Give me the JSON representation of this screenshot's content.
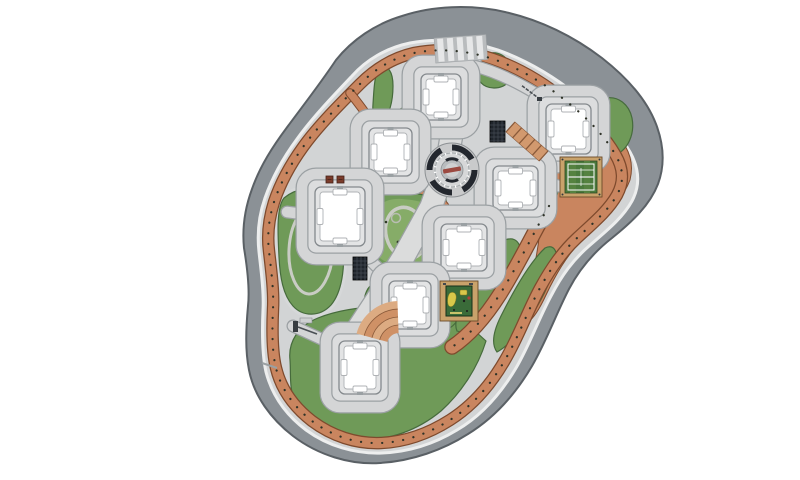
{
  "meta": {
    "title": "Residential complex landscape master plan",
    "canvas": {
      "width": 800,
      "height": 480
    },
    "view": "top-down site plan, no visible text labels"
  },
  "palette": {
    "background": "#FFFFFF",
    "road": "#8B9196",
    "road_border": "#5A6065",
    "sidewalk": "#EDEEEE",
    "pavement": "#D2D4D5",
    "pavement_edge": "#9BA0A3",
    "track": "#C9855F",
    "track_border": "#7E4A2D",
    "lawn": "#6F9A58",
    "lawn_border": "#466B3C",
    "building_ring": "#DCDDDE",
    "building_border": "#84898D",
    "building_fill": "#FFFFFF",
    "building_inner_border": "#AFB2B5",
    "plaza_dark": "#23272E",
    "plaza_ring": "#C9CACB",
    "plaza_accent": "#9C4A41",
    "court_ground": "#C9A26B",
    "court_green": "#4B7A3C",
    "court_line": "#FFFFFF",
    "play_court": "#3A6B39",
    "play_equipment": "#D9C84A",
    "pergola": "#1F242B",
    "stairs_light": "#DCAB82",
    "stairs_dark": "#CF9166",
    "tree_dot": "#2F3328",
    "playground_green": "#86AC68",
    "playground_path": "#C9CCC4"
  },
  "site": {
    "buildings": [
      {
        "id": "building-1",
        "x": 421,
        "y": 74,
        "w": 40,
        "h": 46
      },
      {
        "id": "building-2",
        "x": 369,
        "y": 128,
        "w": 43,
        "h": 48
      },
      {
        "id": "building-3",
        "x": 546,
        "y": 104,
        "w": 45,
        "h": 50
      },
      {
        "id": "building-4",
        "x": 315,
        "y": 187,
        "w": 50,
        "h": 59
      },
      {
        "id": "building-5",
        "x": 493,
        "y": 166,
        "w": 45,
        "h": 44
      },
      {
        "id": "building-6",
        "x": 441,
        "y": 224,
        "w": 46,
        "h": 47
      },
      {
        "id": "building-7",
        "x": 389,
        "y": 281,
        "w": 42,
        "h": 48
      },
      {
        "id": "building-8",
        "x": 339,
        "y": 341,
        "w": 42,
        "h": 53
      }
    ],
    "facilities": [
      {
        "id": "central-plaza",
        "label": "circular amphitheater plaza",
        "cx": 452,
        "cy": 170,
        "r": 27
      },
      {
        "id": "tennis-court",
        "label": "fenced sports court",
        "x": 560,
        "y": 157,
        "w": 42,
        "h": 40
      },
      {
        "id": "kids-court",
        "label": "children playground court",
        "x": 440,
        "y": 281,
        "w": 38,
        "h": 40
      },
      {
        "id": "playground",
        "label": "landscape playground loop",
        "cx": 406,
        "cy": 233
      },
      {
        "id": "pond-lawn",
        "label": "west lawn with walking loop",
        "cx": 310,
        "cy": 250
      },
      {
        "id": "crosswalk",
        "label": "striped entry crosswalk",
        "x": 436,
        "y": 38,
        "stripes": 5
      },
      {
        "id": "fan-stairs",
        "label": "fan-shaped landscape steps",
        "cx": 399,
        "cy": 345
      },
      {
        "id": "ramp-stairs",
        "label": "diagonal stepped ramp",
        "x": 506,
        "y": 130
      }
    ],
    "pergolas": [
      {
        "id": "pergola-east",
        "x": 490,
        "y": 121,
        "w": 15,
        "h": 21
      },
      {
        "id": "pergola-west",
        "x": 353,
        "y": 257,
        "w": 14,
        "h": 23
      }
    ],
    "benches": [
      {
        "id": "bench-1",
        "x": 326,
        "y": 176,
        "w": 7,
        "h": 7
      },
      {
        "id": "bench-2",
        "x": 337,
        "y": 176,
        "w": 7,
        "h": 7
      }
    ],
    "gates": [
      {
        "id": "gate-northeast",
        "label": "north-east entrance barrier"
      },
      {
        "id": "gate-southwest",
        "label": "south-west entrance barrier"
      }
    ],
    "tree_markers": {
      "style": "dotted line along jogging track",
      "color": "#2F3328"
    }
  }
}
